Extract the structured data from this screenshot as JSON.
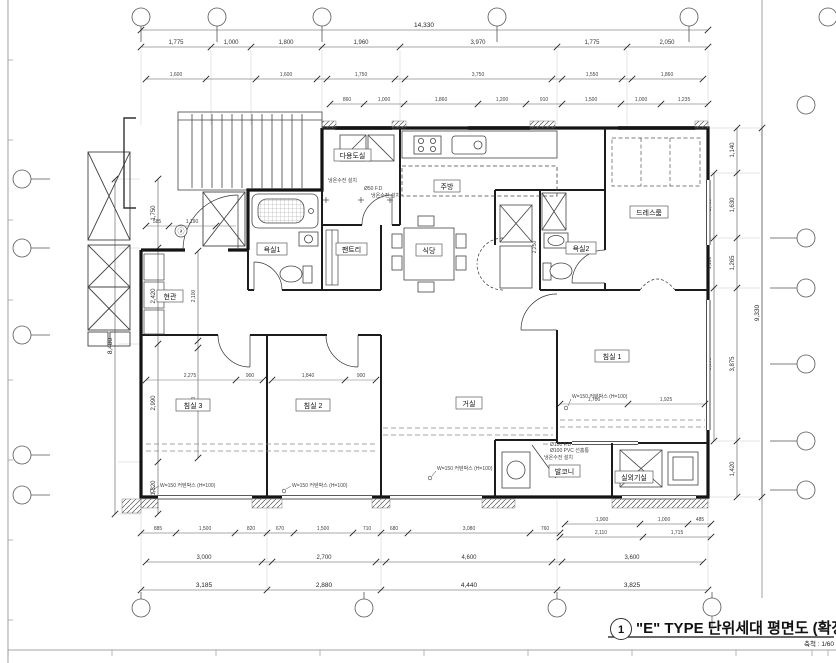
{
  "title_block": {
    "number": "1",
    "title": "\"E\" TYPE 단위세대 평면도 (확장형)",
    "scale": "축척 : 1/60"
  },
  "rooms": {
    "bedroom1": "침실 1",
    "bedroom2": "침실 2",
    "bedroom3": "침실 3",
    "living": "거실",
    "kitchen": "주방",
    "dining": "식당",
    "pantry": "팬트리",
    "utility": "다용도실",
    "entrance": "현관",
    "bath1": "욕실1",
    "bath2": "욕실2",
    "dressroom": "드레스룸",
    "balcony": "발코니",
    "machine_room": "실외기실"
  },
  "annotations": {
    "curtain_box": "W=150 커텐박스 (H=100)",
    "fd100": "Ø100 F.D",
    "pvc_pipe": "Ø100 PVC 선홈통",
    "water_valve": "냉온수전 설치",
    "fd50": "Ø50 F.D",
    "door_mark": "ⓐ"
  },
  "dims": {
    "top_total": "14,330",
    "top_main": [
      "1,775",
      "1,000",
      "1,800",
      "1,960",
      "3,970",
      "1,775",
      "2,050"
    ],
    "top_inner": [
      "1,600",
      "1,600",
      "1,750",
      "3,750",
      "1,550",
      "1,860"
    ],
    "top_small": [
      "860",
      "1,000",
      "1,860",
      "1,200",
      "910",
      "1,500",
      "1,000",
      "1,235"
    ],
    "bottom_small": [
      "885",
      "1,500",
      "820",
      "670",
      "1,500",
      "710",
      "680",
      "3,080",
      "760"
    ],
    "bottom_small_r1": [
      "1,900",
      "1,000",
      "485"
    ],
    "bottom_small_r2": [
      "2,110",
      "1,715"
    ],
    "bottom_mid": [
      "3,000",
      "2,700",
      "4,600",
      "3,600"
    ],
    "bottom_main": [
      "3,185",
      "2,880",
      "4,440",
      "3,825"
    ],
    "left_total": "8,480",
    "left_main": [
      "1,750",
      "2,420",
      "2,990",
      "1,320"
    ],
    "left_inner": [
      "2,100",
      "2,800"
    ],
    "right_total": "9,330",
    "right_main": [
      "1,140",
      "1,630",
      "1,265",
      "3,875",
      "1,420"
    ],
    "right_inner": [
      "1,480",
      "1,180",
      "3,600"
    ],
    "interior": {
      "bed3_w": "2,275",
      "bed3_d": "900",
      "bed2_w": "1,840",
      "bed2_d": "900",
      "bed1_a": "1,700",
      "bed1_b": "1,925",
      "ent_a": "585",
      "ent_b": "1,190",
      "kit_v": "2,250"
    }
  }
}
